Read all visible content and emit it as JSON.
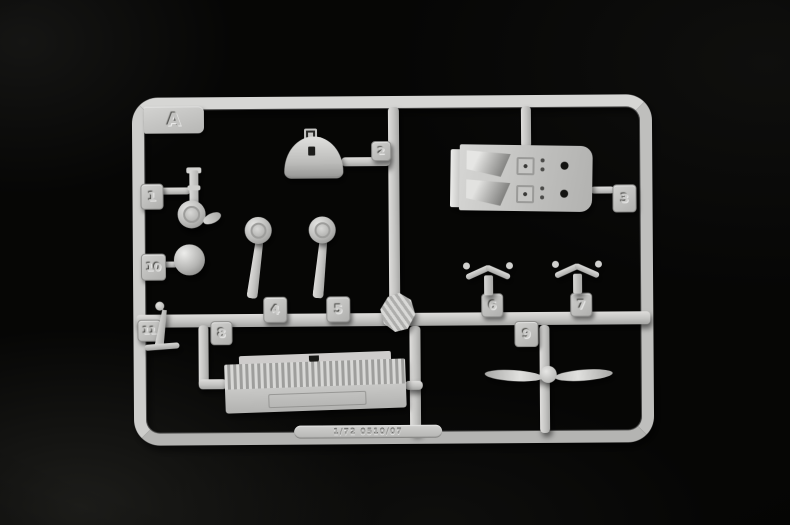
{
  "sprue": {
    "letter": "A",
    "embossed_code": "1/72 0510/07",
    "tags": {
      "t1": "1",
      "t2": "2",
      "t3": "3",
      "t4": "4",
      "t5": "5",
      "t6": "6",
      "t7": "7",
      "t8": "8",
      "t9": "9",
      "t10": "10",
      "t11": "11"
    }
  },
  "colors": {
    "plastic": "#c8c8c6",
    "plastic_highlight": "#e8e8e6",
    "plastic_shadow": "#9a9a98",
    "background": "#060605"
  }
}
